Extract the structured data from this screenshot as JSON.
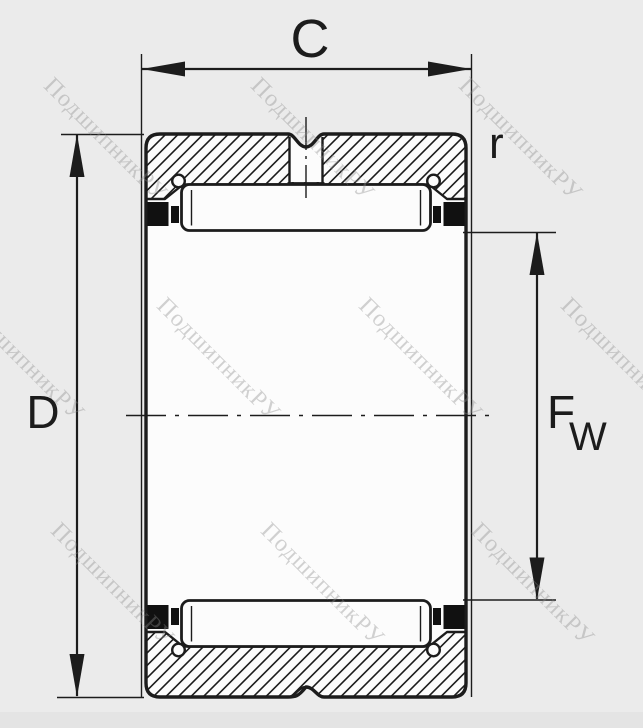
{
  "colors": {
    "background": "#ebebeb",
    "paper": "#fcfcfc",
    "line": "#1c1c1c",
    "seal": "#111111",
    "watermark": "#8b8b8b",
    "bottom_strip": "#e4e4e4"
  },
  "labels": {
    "width": "C",
    "outer_diameter": "D",
    "corner_radius": "r",
    "bore_main": "F",
    "bore_sub": "W"
  },
  "watermark": {
    "text": "ПодшипникРУ",
    "opacity": 0.38,
    "font_size": 24,
    "tiles": [
      {
        "x": 105,
        "y": 140
      },
      {
        "x": 312,
        "y": 140
      },
      {
        "x": 520,
        "y": 140
      },
      {
        "x": 22,
        "y": 360
      },
      {
        "x": 218,
        "y": 360
      },
      {
        "x": 420,
        "y": 360
      },
      {
        "x": 622,
        "y": 360
      },
      {
        "x": 112,
        "y": 585
      },
      {
        "x": 322,
        "y": 585
      },
      {
        "x": 532,
        "y": 585
      }
    ]
  }
}
